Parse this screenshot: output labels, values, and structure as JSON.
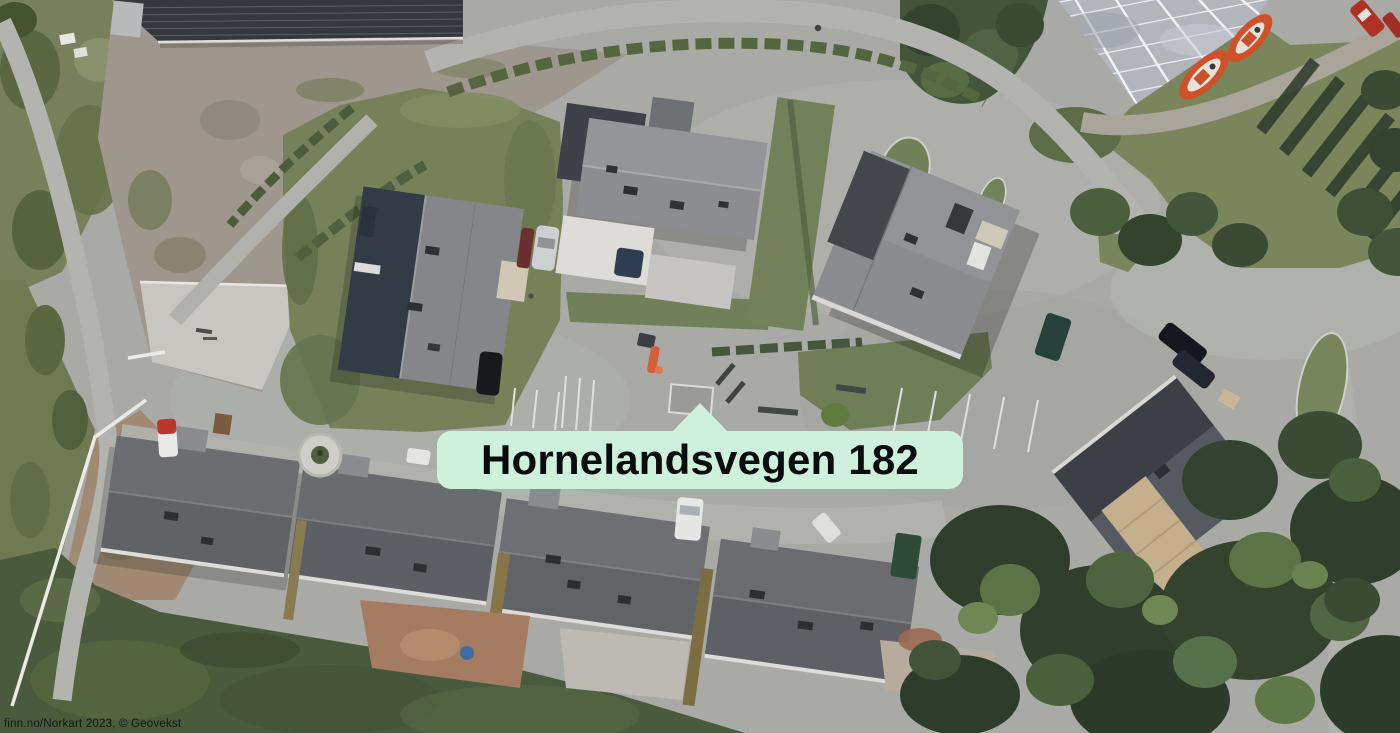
{
  "marker": {
    "label": "Hornelandsvegen 182",
    "pointer": "triangle-up-icon"
  },
  "attribution": {
    "text": "finn.no/Norkart 2023, © Geovekst"
  },
  "colors": {
    "label-bg": "#cdf1dc",
    "label-text": "#0b0c0e",
    "attribution-text": "#161616",
    "asphalt": "#a9aaa6",
    "gravel": "#9d978d",
    "lawn-green": "#4a5a3c",
    "roof-gray": "#85878a",
    "solar-roof": "#34373c",
    "boat-orange": "#cf5129",
    "tree-green": "#33432e"
  },
  "scene": {
    "type": "aerial-orthophoto",
    "features": [
      "winding residential roads",
      "dark solar-panel roof building",
      "greenhouse with two orange boats",
      "detached houses with gray roofs",
      "terraced house row with backyards",
      "parking areas with marked stalls",
      "lawns, hedges and tree clusters",
      "parked cars"
    ]
  }
}
